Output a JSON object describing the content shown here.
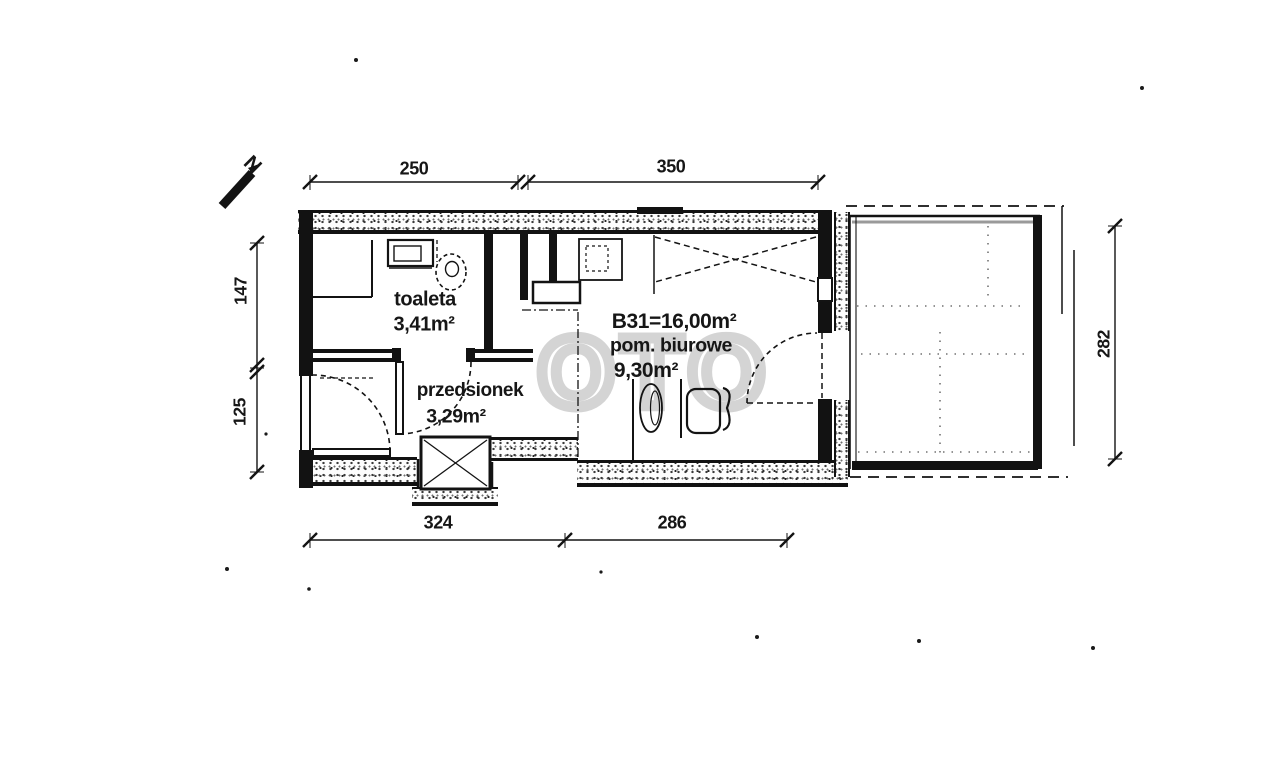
{
  "plan": {
    "north_label": "N",
    "watermark_text": "OTO",
    "rooms": {
      "toaleta": {
        "name": "toaleta",
        "area": "3,41m²"
      },
      "przedsionek": {
        "name": "przedsionek",
        "area": "3,29m²"
      },
      "biurowe": {
        "unit": "B31=16,00m²",
        "name": "pom. biurowe",
        "area": "9,30m²"
      }
    },
    "dimensions_cm": {
      "top_left_width": "250",
      "top_right_width": "350",
      "left_upper_height": "147",
      "left_lower_height": "125",
      "bottom_left_width": "324",
      "bottom_right_width": "286",
      "balcony_height": "282"
    }
  }
}
